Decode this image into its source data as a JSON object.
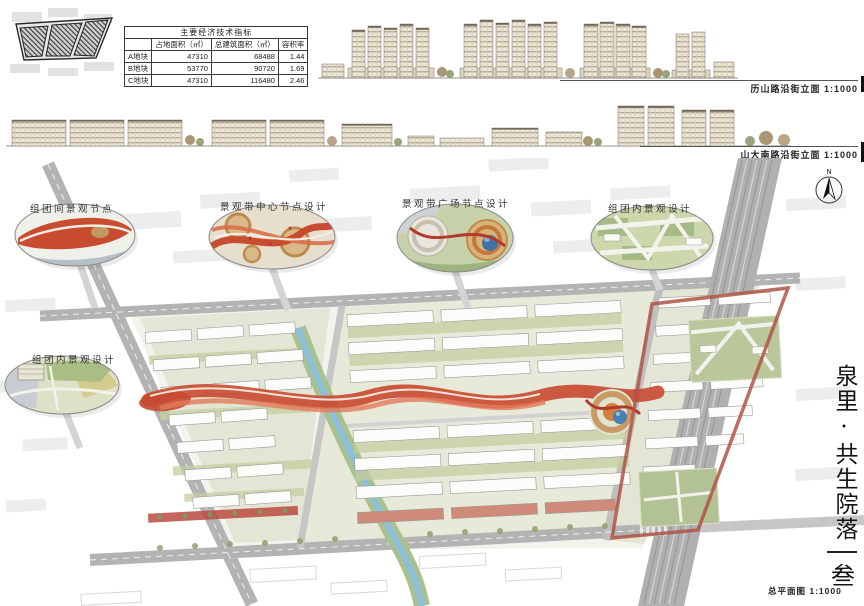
{
  "board": {
    "project_title": "泉里·共生院落",
    "sheet_number": "叁"
  },
  "indicators_table": {
    "title": "主要经济技术指标",
    "col_headers": [
      "占地面积（㎡）",
      "总建筑面积（㎡）",
      "容积率"
    ],
    "rows": [
      {
        "name": "A地块",
        "land_area": "47310",
        "gfa": "68488",
        "far": "1.44"
      },
      {
        "name": "B地块",
        "land_area": "53770",
        "gfa": "90720",
        "far": "1.69"
      },
      {
        "name": "C地块",
        "land_area": "47310",
        "gfa": "116480",
        "far": "2.46"
      }
    ]
  },
  "elevations": {
    "lishan_label": "历山路沿街立面 1:1000",
    "shanda_label": "山大南路沿街立面 1:1000"
  },
  "plan": {
    "label": "总平面图 1:1000",
    "north_label": "N",
    "callouts": [
      {
        "label": "组团间景观节点"
      },
      {
        "label": "景观带中心节点设计"
      },
      {
        "label": "景观带广场节点设计"
      },
      {
        "label": "组团内景观设计"
      },
      {
        "label": "组团内景观设计"
      }
    ]
  },
  "colors": {
    "ribbon_red": "#c8492f",
    "water_blue": "#8fbfd4",
    "landscape_green": "#b7c695",
    "road_gray": "#b2b2b2",
    "plaza_dome_blue": "#4a7fb5",
    "building_beige": "#ece6d8"
  }
}
